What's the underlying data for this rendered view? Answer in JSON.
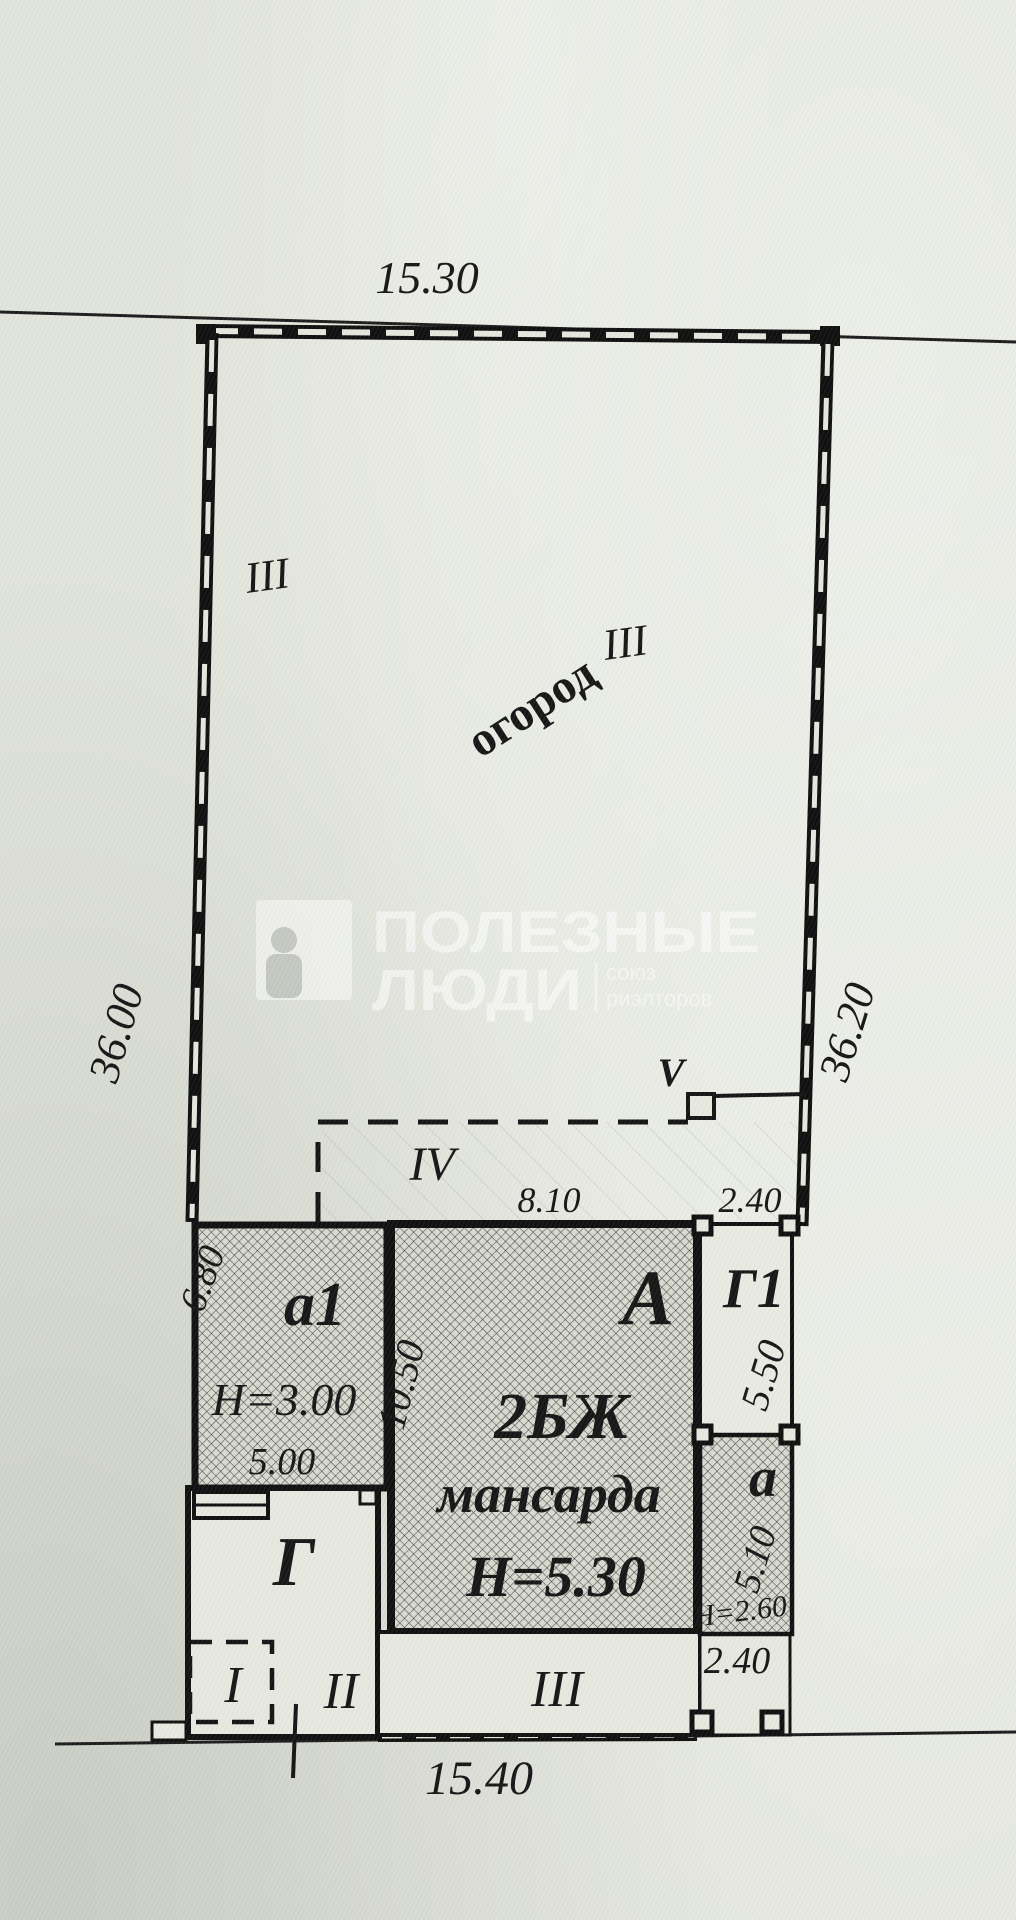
{
  "site_plan": {
    "boundary": {
      "top_length": "15.30",
      "bottom_length": "15.40",
      "left_length": "36.00",
      "right_length": "36.20",
      "left_mark": "III",
      "right_mark": "III",
      "bottom_mark": "III"
    },
    "garden": {
      "label": "огород"
    },
    "annotations": {
      "region_iv": "IV",
      "point_v": "V",
      "region_i": "I",
      "region_ii": "II"
    },
    "building_a1": {
      "label": "а1",
      "height": "Н=3.00",
      "width": "5.00",
      "depth": "6.80"
    },
    "building_A": {
      "label": "А",
      "type": "2БЖ",
      "attic": "мансарда",
      "height": "Н=5.30",
      "depth": "10.50",
      "top_width": "8.10"
    },
    "building_G1": {
      "label": "Г1",
      "depth": "5.50",
      "top_width": "2.40"
    },
    "building_a": {
      "label": "а",
      "depth": "5.10",
      "height": "Н=2.60",
      "porch_width": "2.40"
    },
    "building_G": {
      "label": "Г"
    },
    "watermark": {
      "brand_line1": "ПОЛЕЗНЫЕ",
      "brand_line2": "ЛЮДИ",
      "tagline_line1": "союз",
      "tagline_line2": "риэлторов"
    }
  }
}
